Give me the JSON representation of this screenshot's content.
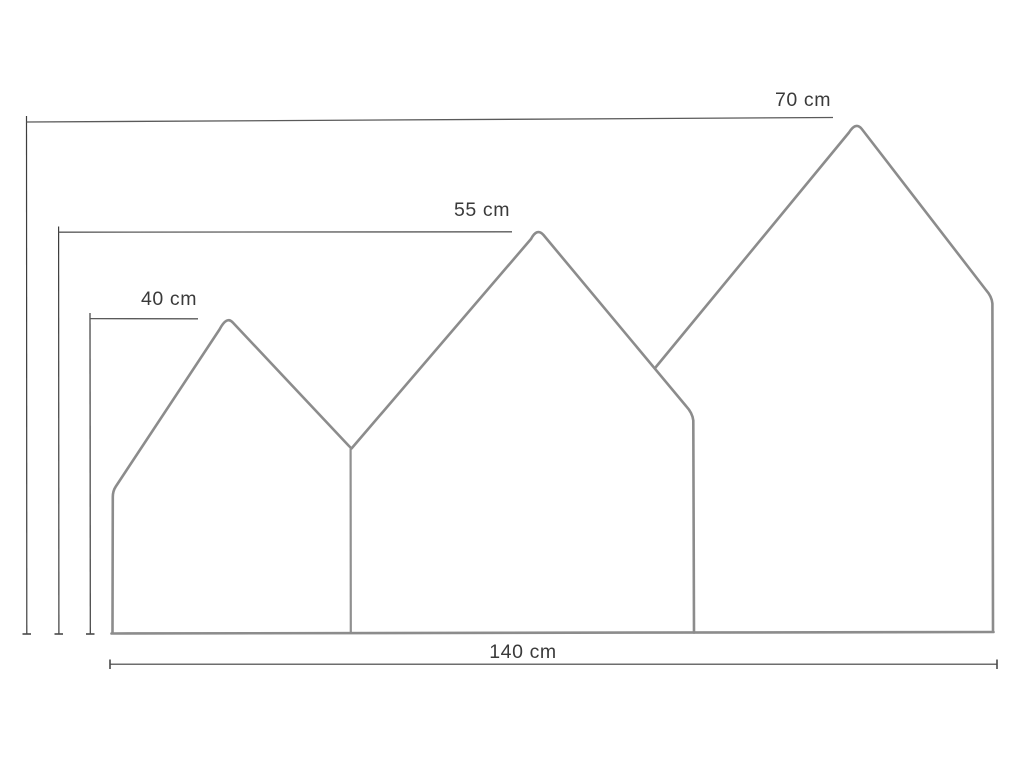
{
  "page": {
    "background": "#ffffff"
  },
  "diagram": {
    "kind": "technical-dimension-drawing",
    "subject": "headboard silhouette made of three house-shaped panels of increasing height",
    "units": "cm",
    "colors": {
      "outline": "#8c8c8c",
      "dimension_lines": "#5a5a5a",
      "label_text": "#3a3a3a",
      "background": "#ffffff"
    },
    "dimensions": [
      {
        "id": "tall-house-height",
        "value": 70,
        "unit": "cm",
        "label": "70 cm"
      },
      {
        "id": "middle-house-height",
        "value": 55,
        "unit": "cm",
        "label": "55 cm"
      },
      {
        "id": "small-house-height",
        "value": 40,
        "unit": "cm",
        "label": "40 cm"
      },
      {
        "id": "total-width",
        "value": 140,
        "unit": "cm",
        "label": "140 cm"
      }
    ]
  }
}
